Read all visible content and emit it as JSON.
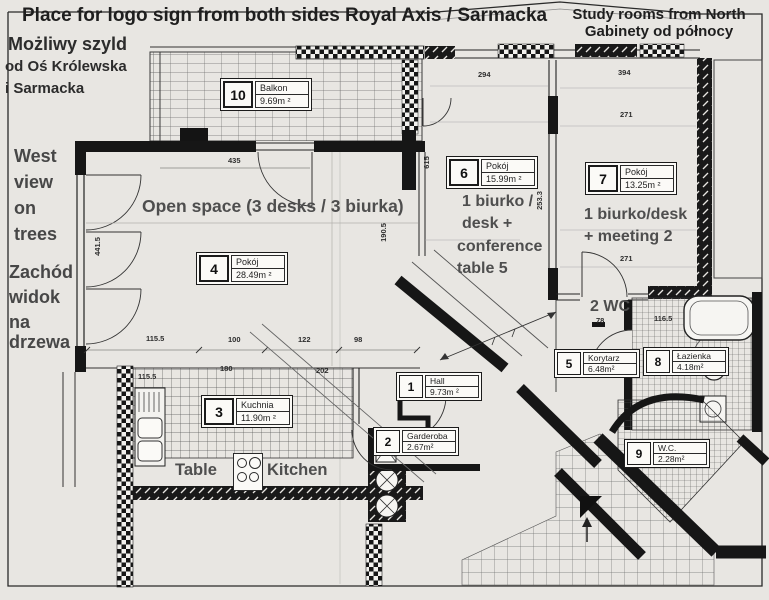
{
  "page": {
    "background": "#e8e6e2",
    "ink": "#161616",
    "note_color": "#474747"
  },
  "annotations": {
    "title_left": "Place for logo sign from both sides Royal Axis / Sarmacka",
    "title_right_line1": "Study rooms from North",
    "title_right_line2": "Gabinety od północy",
    "left_note_line1": "Możliwy szyld",
    "left_note_line2": "od Oś Królewska",
    "left_note_line3": "i Sarmacka",
    "west_line1": "West",
    "west_line2": "view",
    "west_line3": "on",
    "west_line4": "trees",
    "zachod_line1": "Zachód",
    "zachod_line2": "widok",
    "zachod_line3": "na",
    "zachod_line4": "drzewa",
    "open_space": "Open space (3 desks / 3 biurka)",
    "room6_note_line1": "1 biurko /",
    "room6_note_line2": "desk +",
    "room6_note_line3": "conference",
    "room6_note_line4": "table 5",
    "room7_note_line1": "1 biurko/desk",
    "room7_note_line2": "+ meeting 2",
    "wc_note": "2 WC",
    "table_label": "Table",
    "kitchen_label": "Kitchen"
  },
  "rooms": [
    {
      "num": "10",
      "name": "Balkon",
      "area": "9.69m ²"
    },
    {
      "num": "4",
      "name": "Pokój",
      "area": "28.49m ²"
    },
    {
      "num": "6",
      "name": "Pokój",
      "area": "15.99m ²"
    },
    {
      "num": "7",
      "name": "Pokój",
      "area": "13.25m ²"
    },
    {
      "num": "5",
      "name": "Korytarz",
      "area": "6.48m²"
    },
    {
      "num": "8",
      "name": "Łazienka",
      "area": "4.18m²"
    },
    {
      "num": "1",
      "name": "Hall",
      "area": "9.73m ²"
    },
    {
      "num": "2",
      "name": "Garderoba",
      "area": "2.67m²"
    },
    {
      "num": "3",
      "name": "Kuchnia",
      "area": "11.90m ²"
    },
    {
      "num": "9",
      "name": "W.C.",
      "area": "2.28m²"
    }
  ],
  "dimensions": [
    {
      "t": "435",
      "x": 228,
      "y": 156
    },
    {
      "t": "441.5",
      "x": 88,
      "y": 242,
      "v": true
    },
    {
      "t": "190.5",
      "x": 374,
      "y": 228,
      "v": true
    },
    {
      "t": "115.5",
      "x": 146,
      "y": 334
    },
    {
      "t": "100",
      "x": 228,
      "y": 335
    },
    {
      "t": "122",
      "x": 298,
      "y": 335
    },
    {
      "t": "98",
      "x": 354,
      "y": 335
    },
    {
      "t": "115.5",
      "x": 138,
      "y": 372
    },
    {
      "t": "180",
      "x": 220,
      "y": 364
    },
    {
      "t": "202",
      "x": 316,
      "y": 366
    },
    {
      "t": "615",
      "x": 420,
      "y": 158,
      "v": true
    },
    {
      "t": "294",
      "x": 478,
      "y": 70
    },
    {
      "t": "394",
      "x": 618,
      "y": 68
    },
    {
      "t": "271",
      "x": 620,
      "y": 110
    },
    {
      "t": "271",
      "x": 620,
      "y": 254
    },
    {
      "t": "253.3",
      "x": 530,
      "y": 196,
      "v": true
    },
    {
      "t": "78",
      "x": 596,
      "y": 316
    },
    {
      "t": "116.5",
      "x": 654,
      "y": 314
    }
  ]
}
